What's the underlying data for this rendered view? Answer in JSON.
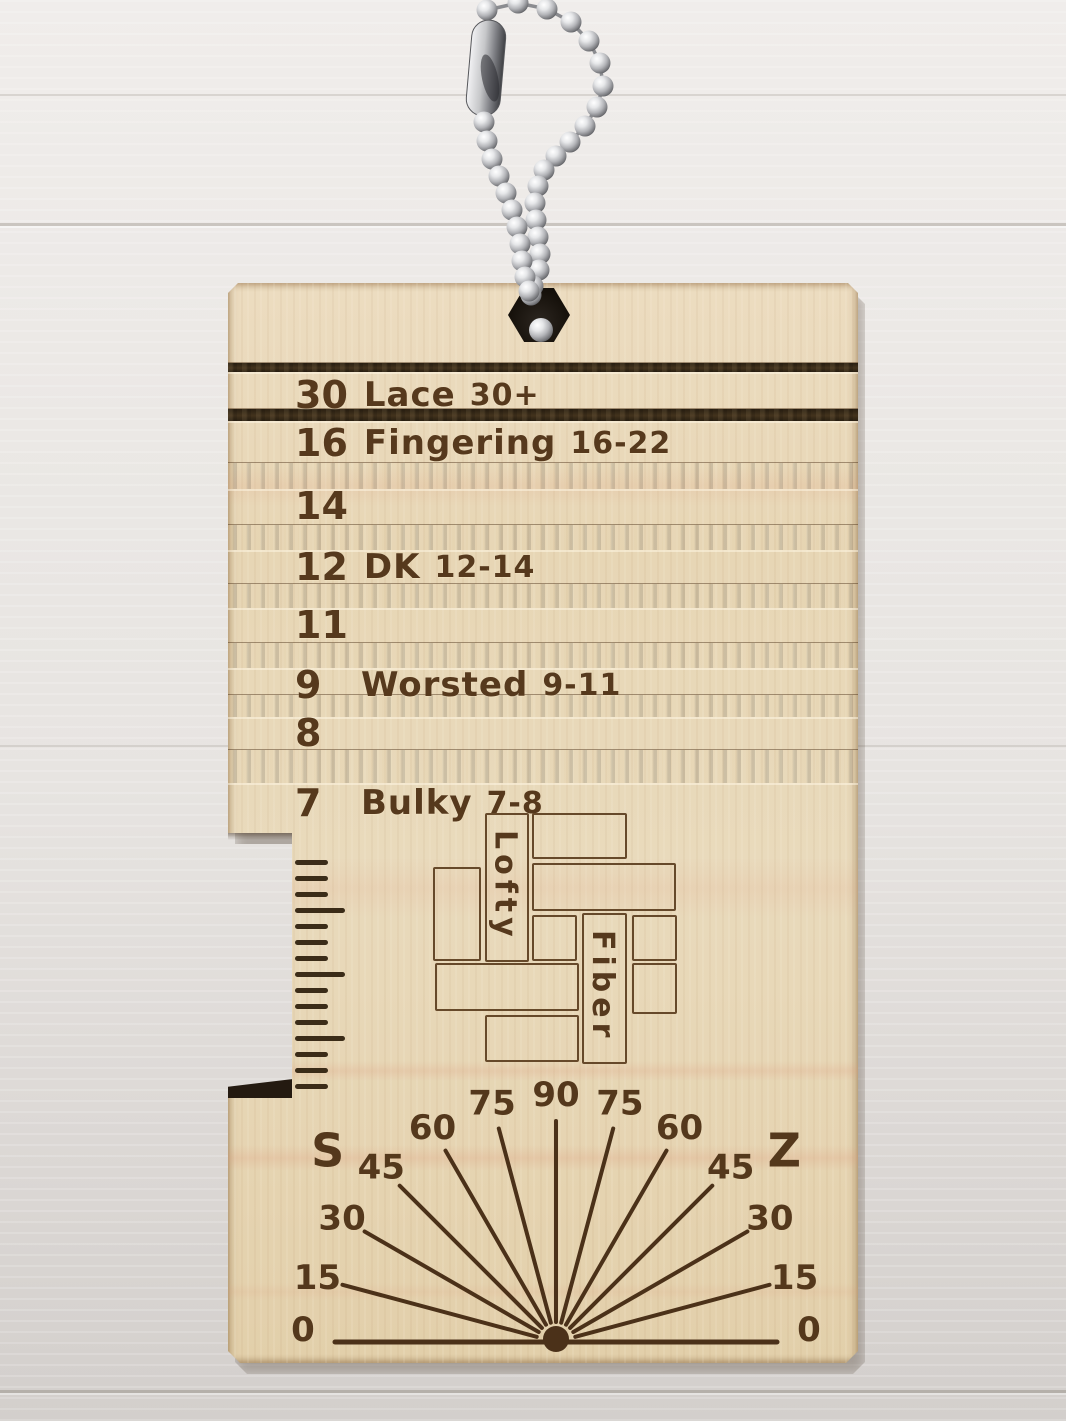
{
  "gauge": {
    "rows": [
      {
        "wpi": "30",
        "name": "Lace",
        "range": "30+"
      },
      {
        "wpi": "16",
        "name": "Fingering",
        "range": "16-22"
      },
      {
        "wpi": "14",
        "name": "",
        "range": ""
      },
      {
        "wpi": "12",
        "name": "DK",
        "range": "12-14"
      },
      {
        "wpi": "11",
        "name": "",
        "range": ""
      },
      {
        "wpi": "9",
        "name": "Worsted",
        "range": "9-11"
      },
      {
        "wpi": "8",
        "name": "",
        "range": ""
      },
      {
        "wpi": "7",
        "name": "Bulky",
        "range": "7-8"
      }
    ]
  },
  "logo": {
    "word1": "Lofty",
    "word2": "Fiber"
  },
  "protractor": {
    "left_label": "S",
    "right_label": "Z",
    "angle_labels": [
      "0",
      "15",
      "30",
      "45",
      "60",
      "75",
      "90",
      "75",
      "60",
      "45",
      "30",
      "15",
      "0"
    ]
  },
  "ruler": {
    "tick_count": 15
  },
  "colors": {
    "wood": "#e7d7b6",
    "slot_dark": "#43331c",
    "engraving": "#56391d",
    "background": "#e9e6e3",
    "chain_silver": "#c9cacd"
  }
}
